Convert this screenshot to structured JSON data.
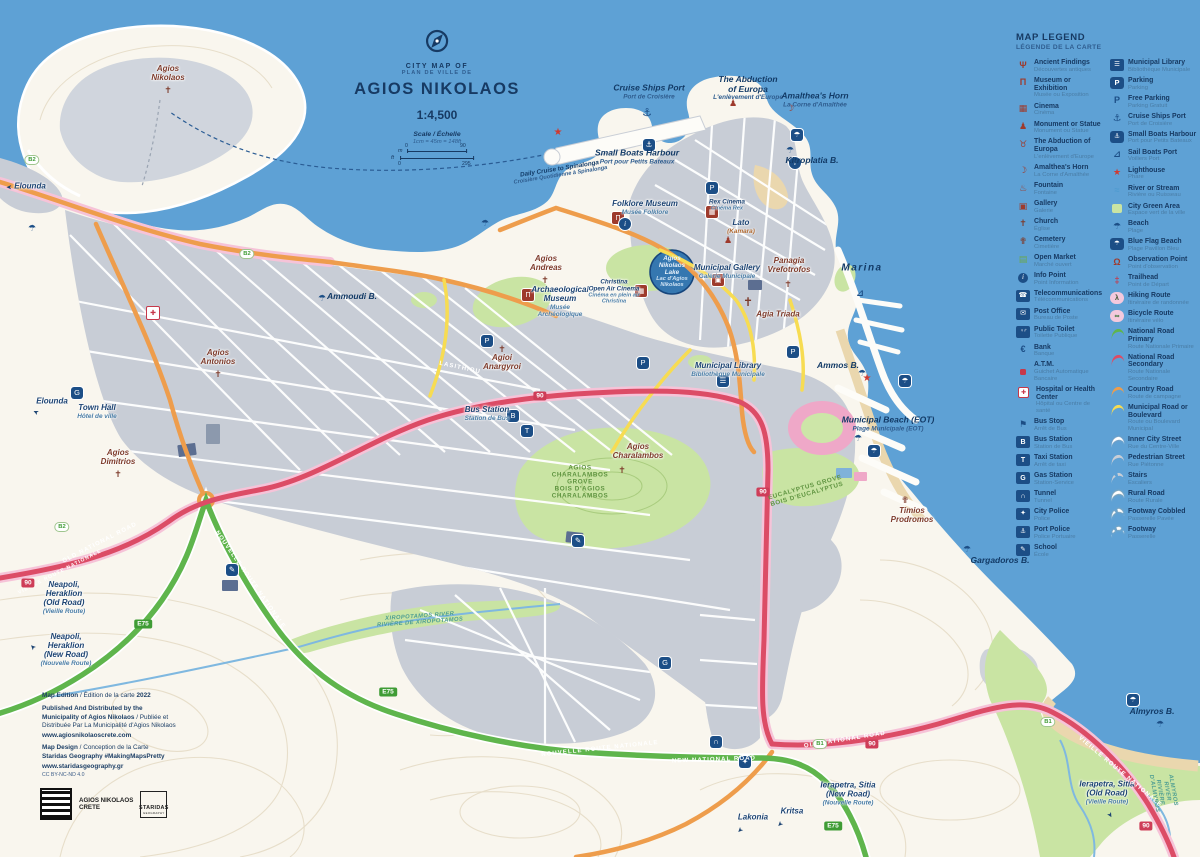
{
  "title_block": {
    "kicker_en": "CITY MAP OF",
    "kicker_fr": "PLAN DE VILLE DE",
    "title": "AGIOS NIKOLAOS",
    "scale_ratio": "1:4,500",
    "scale_label": "Scale / Échelle",
    "scale_eq": "1cm = 45m = 148ft",
    "m_unit": "m",
    "m0": "0",
    "m90": "90",
    "ft_unit": "ft",
    "ft0": "0",
    "ft295": "295"
  },
  "legend": {
    "title_en": "MAP LEGEND",
    "title_fr": "LÉGENDE DE LA CARTE",
    "columns": [
      {
        "items": [
          {
            "icon": "ancient",
            "en": "Ancient Findings",
            "fr": "Découvertes antiques"
          },
          {
            "icon": "museum",
            "en": "Museum or Exhibition",
            "fr": "Musée ou Exposition"
          },
          {
            "icon": "cinema",
            "en": "Cinema",
            "fr": "Cinéma"
          },
          {
            "icon": "monument",
            "en": "Monument or Statue",
            "fr": "Monument ou Statue"
          },
          {
            "icon": "abduction",
            "en": "The Abduction of Europa",
            "fr": "L'enlèvement d'Europe"
          },
          {
            "icon": "amalthea",
            "en": "Amalthea's Horn",
            "fr": "La Corne d'Amalthée"
          },
          {
            "icon": "fountain",
            "en": "Fountain",
            "fr": "Fontaine"
          },
          {
            "icon": "gallery",
            "en": "Gallery",
            "fr": "Galerie"
          },
          {
            "icon": "church",
            "en": "Church",
            "fr": "Église"
          },
          {
            "icon": "cemetery",
            "en": "Cemetery",
            "fr": "Cimetière"
          },
          {
            "icon": "market",
            "en": "Open Market",
            "fr": "Marché ouvert"
          },
          {
            "icon": "info",
            "en": "Info Point",
            "fr": "Point Information"
          },
          {
            "icon": "telecom",
            "en": "Telecommunications",
            "fr": "Télécommunications"
          },
          {
            "icon": "post",
            "en": "Post Office",
            "fr": "Bureau de Poste"
          },
          {
            "icon": "toilet",
            "en": "Public Toilet",
            "fr": "Toilette Publique"
          },
          {
            "icon": "bank",
            "en": "Bank",
            "fr": "Banque"
          },
          {
            "icon": "atm",
            "en": "A.T.M.",
            "fr": "Guichet Automatique Bancaire"
          },
          {
            "icon": "hospital",
            "en": "Hospital or Health Center",
            "fr": "Hôpital ou Centre de santé"
          },
          {
            "icon": "busstop",
            "en": "Bus Stop",
            "fr": "Arrêt de Bus"
          },
          {
            "icon": "busstation",
            "en": "Bus Station",
            "fr": "Station de Bus"
          },
          {
            "icon": "taxi",
            "en": "Taxi Station",
            "fr": "Arrêt de taxi"
          },
          {
            "icon": "gas",
            "en": "Gas Station",
            "fr": "Station-Service"
          },
          {
            "icon": "tunnel",
            "en": "Tunnel",
            "fr": "Tunnel"
          },
          {
            "icon": "citypolice",
            "en": "City Police",
            "fr": "Police"
          },
          {
            "icon": "portpolice",
            "en": "Port Police",
            "fr": "Police Portuaire"
          },
          {
            "icon": "school",
            "en": "School",
            "fr": "École"
          }
        ]
      },
      {
        "items": [
          {
            "icon": "library",
            "en": "Municipal Library",
            "fr": "Bibliothèque Municipale"
          },
          {
            "icon": "parking",
            "en": "Parking",
            "fr": "Parking"
          },
          {
            "icon": "freeparking",
            "en": "Free Parking",
            "fr": "Parking Gratuit"
          },
          {
            "icon": "cruise",
            "en": "Cruise Ships Port",
            "fr": "Port de Croisière"
          },
          {
            "icon": "smallboats",
            "en": "Small Boats Harbour",
            "fr": "Port pour Petits Bateaux"
          },
          {
            "icon": "sailboats",
            "en": "Sail Boats Port",
            "fr": "Voiliers Port"
          },
          {
            "icon": "lighthouse",
            "en": "Lighthouse",
            "fr": "Phare"
          },
          {
            "icon": "river",
            "en": "River or Stream",
            "fr": "Rivière ou Ruisseau"
          },
          {
            "icon": "greenarea",
            "en": "City Green Area",
            "fr": "Espace vert de la ville"
          },
          {
            "icon": "beach",
            "en": "Beach",
            "fr": "Plage"
          },
          {
            "icon": "blueflag",
            "en": "Blue Flag Beach",
            "fr": "Plage Pavillon Bleu"
          },
          {
            "icon": "observation",
            "en": "Observation Point",
            "fr": "Point d'observation"
          },
          {
            "icon": "trailhead",
            "en": "Trailhead",
            "fr": "Point de Départ"
          },
          {
            "icon": "hiking",
            "en": "Hiking Route",
            "fr": "Itinéraire de randonnée"
          },
          {
            "icon": "bicycle",
            "en": "Bicycle Route",
            "fr": "Itinéraire vélo"
          },
          {
            "icon": "natprimary",
            "en": "National Road Primary",
            "fr": "Route Nationale Primaire"
          },
          {
            "icon": "natsecondary",
            "en": "National Road Secondary",
            "fr": "Route Nationale Secondaire"
          },
          {
            "icon": "country",
            "en": "Country Road",
            "fr": "Route de campagne"
          },
          {
            "icon": "municipalroad",
            "en": "Municipal Road or Boulevard",
            "fr": "Route ou Boulevard Municipal"
          },
          {
            "icon": "innercity",
            "en": "Inner City Street",
            "fr": "Rue du Centre-Ville"
          },
          {
            "icon": "pedestrian",
            "en": "Pedestrian Street",
            "fr": "Rue Piétonne"
          },
          {
            "icon": "stairs",
            "en": "Stairs",
            "fr": "Escaliers"
          },
          {
            "icon": "rural",
            "en": "Rural Road",
            "fr": "Route Rurale"
          },
          {
            "icon": "cobbled",
            "en": "Footway Cobbled",
            "fr": "Passerelle Pavée"
          },
          {
            "icon": "footway",
            "en": "Footway",
            "fr": "Passerelle"
          }
        ]
      }
    ]
  },
  "map": {
    "labels": {
      "island_church": {
        "en": "Agios\nNikolaos"
      },
      "elounda_top": {
        "en": "Elounda"
      },
      "elounda2": {
        "en": "Elounda"
      },
      "town_hall": {
        "en": "Town Hall",
        "fr": "Hôtel de ville"
      },
      "agios_dimitrios": {
        "en": "Agios\nDimitrios"
      },
      "agios_antonios": {
        "en": "Agios\nAntonios"
      },
      "ammoudi_b": {
        "en": "Ammoudi B."
      },
      "folklore": {
        "en": "Folklore Museum",
        "fr": "Musée Folklore"
      },
      "rex": {
        "en": "Rex Cinema",
        "fr": "Cinéma Rex"
      },
      "lato": {
        "en": "Lato",
        "fr": "(Kamara)"
      },
      "lake": {
        "en": "Agios\nNikolaos\nLake",
        "fr": "Lac d'Agios\nNikolaos"
      },
      "municipal_gallery": {
        "en": "Municipal Gallery",
        "fr": "Galerie Municipale"
      },
      "panagia": {
        "en": "Panagia\nVrefotrofos"
      },
      "agia_triada": {
        "en": "Agia Triada"
      },
      "kitroplatia": {
        "en": "Kitroplatia B."
      },
      "marina": {
        "en": "Marina"
      },
      "ammos_b": {
        "en": "Ammos B."
      },
      "municipal_beach": {
        "en": "Municipal Beach (EOT)",
        "fr": "Plage Municipale (EOT)"
      },
      "timios": {
        "en": "Timios\nProdromos"
      },
      "gargadoros": {
        "en": "Gargadoros B."
      },
      "almyros_b": {
        "en": "Almyros B."
      },
      "eucalyptus": {
        "en": "EUCALYPTUS GROVE",
        "fr": "BOIS D'EUCALYPTUS"
      },
      "char_grove": {
        "en": "AGIOS\nCHARALAMBOS\nGROVE",
        "fr": "BOIS D'AGIOS\nCHARALAMBOS"
      },
      "agios_char": {
        "en": "Agios\nCharalambos"
      },
      "bus_station": {
        "en": "Bus Station",
        "fr": "Station de Bus"
      },
      "library": {
        "en": "Municipal Library",
        "fr": "Bibliothèque Municipale"
      },
      "arch_museum": {
        "en": "Archaeological\nMuseum",
        "fr": "Musée\nArchéologique"
      },
      "andreas": {
        "en": "Agios\nAndreas"
      },
      "christina": {
        "en": "Christina\nOpen Air Cinema",
        "fr": "Cinéma en plein air\nChristina"
      },
      "anargyroi": {
        "en": "Agioi\nAnargyroi"
      },
      "cruise_port": {
        "en": "Cruise Ships Port",
        "fr": "Port de Croisière"
      },
      "abduction": {
        "en": "The Abduction\nof Europa",
        "fr": "L'enlèvement d'Europe"
      },
      "amalthea": {
        "en": "Amalthea's Horn",
        "fr": "La Corne d'Amalthée"
      },
      "small_boats": {
        "en": "Small Boats Harbour",
        "fr": "Port pour Petits Bateaux"
      },
      "spinalonga": {
        "en": "Daily Cruise to Spinalonga",
        "fr": "Croisière Quotidienne à Spinalonga"
      },
      "xiropotamos": {
        "en": "XIROPOTAMOS RIVER",
        "fr": "RIVIÈRE DE XIROPOTAMOS"
      },
      "almyros_river": {
        "en": "ALMYROS RIVER",
        "fr": "RIVIÈRE D'ALMYROS"
      },
      "neapoli_old": {
        "en": "Neapoli,\nHeraklion\n(Old Road)",
        "fr": "(Vieille Route)"
      },
      "neapoli_new": {
        "en": "Neapoli,\nHeraklion\n(New Road)",
        "fr": "(Nouvelle Route)"
      },
      "ierapetra_old": {
        "en": "Ierapetra, Sitia\n(Old Road)",
        "fr": "(Vieille Route)"
      },
      "ierapetra_new": {
        "en": "Ierapetra, Sitia\n(New Road)",
        "fr": "(Nouvelle Route)"
      },
      "kritsa": {
        "en": "Kritsa"
      },
      "lakonia": {
        "en": "Lakonia"
      }
    },
    "road_labels": {
      "old_national": "OLD NATIONAL ROAD",
      "vieille_route": "VIEILLE ROUTE NATIONALE",
      "nouvelle_route": "NOUVELLE ROUTE NATIONALE",
      "new_national": "NEW NATIONAL ROAD",
      "lasithiou": "LASITHIOU"
    },
    "badges": {
      "b90": "90",
      "e75": "E75",
      "b1": "B1",
      "b2": "B2"
    }
  },
  "credits": {
    "edition_b": "Map Edition",
    "edition_r": " / Édition de la carte ",
    "edition_year": "2022",
    "pub1": "Published And Distributed by the",
    "pub2_b": "Municipality of Agios Nikolaos",
    "pub2_r": " / Publiée et",
    "pub3": "Distribuée Par La Municipalité d'Agios Nikolaos",
    "web1": "www.agiosnikolaoscrete.com",
    "design_b": "Map Design",
    "design_r": " / Conception de la Carte",
    "design2": "Staridas Geography #MakingMapsPretty",
    "web2": "www.staridasgeography.gr",
    "cc": "CC BY-NC-ND 4.0",
    "qr_label": "AGIOS NIKOLAOS\nCRETE",
    "logo1": "STARIDAS",
    "logo2": "GEOGRAPHY"
  },
  "colors": {
    "sea": "#5EA1D5",
    "land": "#F9F6EE",
    "urban": "#C8CDD6",
    "streets": "#FFFFFF",
    "green_area": "#C9E4A3",
    "sand": "#EAD7AE",
    "lake": "#3577B0",
    "road_primary": "#5FB54C",
    "road_secondary": "#DC4C66",
    "road_secondary_casing": "#F6C3D8",
    "road_country": "#EE9D4C",
    "road_municipal": "#F7DC52",
    "label_navy": "#1D4473",
    "label_fr": "#4A7DA6",
    "church_label": "#7D3A2A",
    "badge_red": "#CE3D58",
    "badge_green": "#3F9C35",
    "green_label": "#5F9440"
  }
}
